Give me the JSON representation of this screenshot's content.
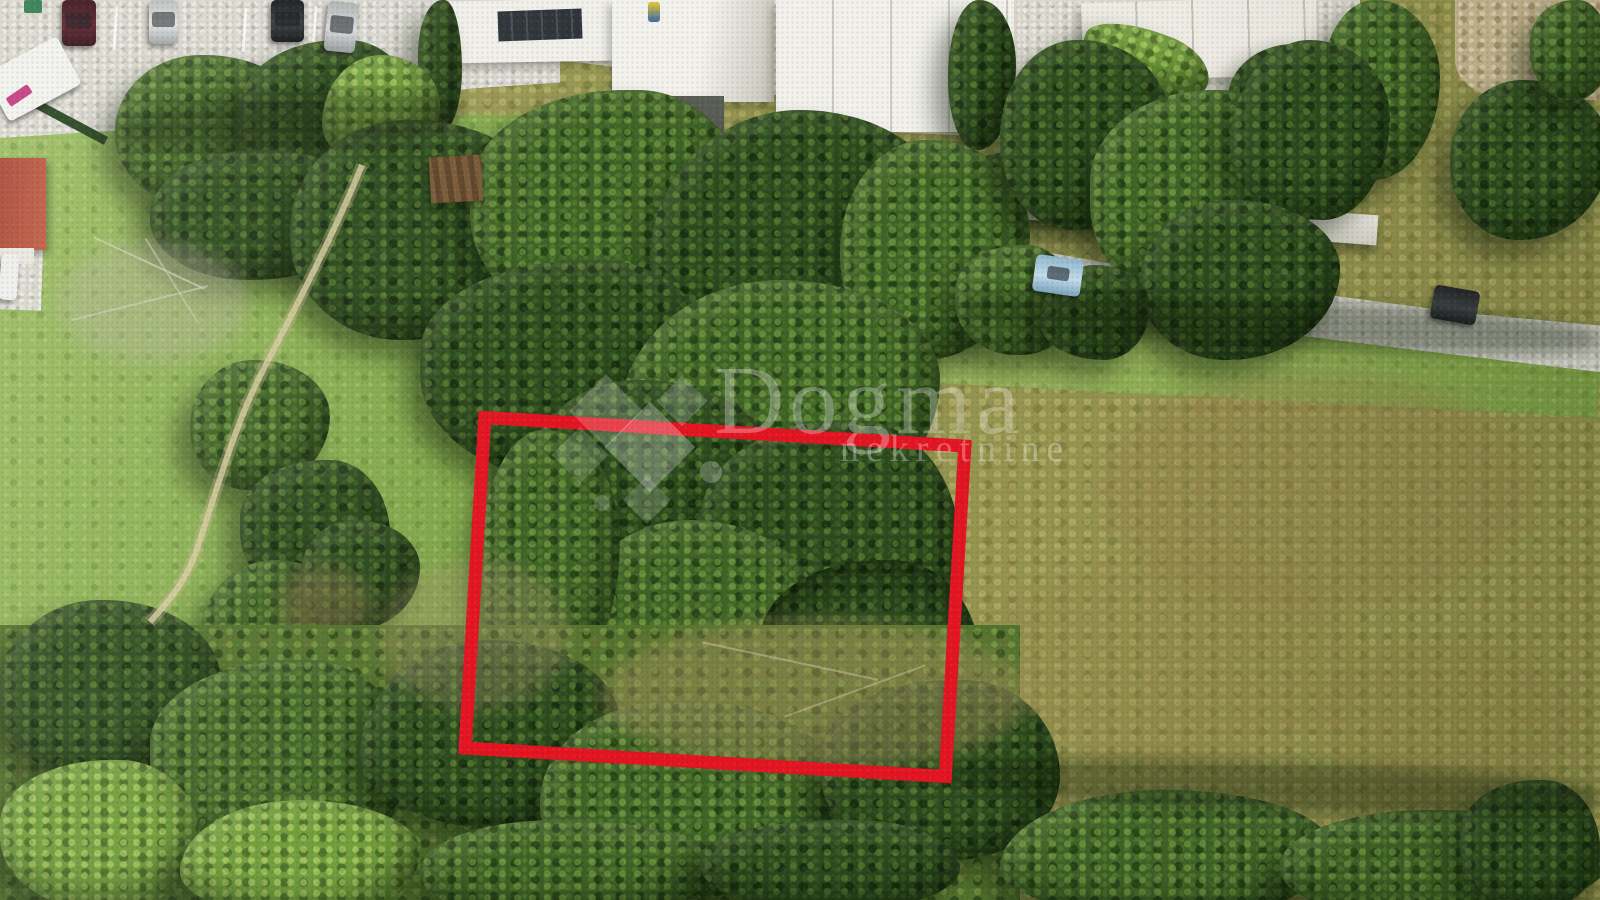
{
  "image": {
    "kind": "aerial-drone-photo",
    "subject": "Land plot for sale outlined in red, surrounded by trees, grass field and dry meadow, street with houses and parked cars at top",
    "width_px": 1600,
    "height_px": 900
  },
  "watermark": {
    "brand": "Dogma",
    "subtitle": "nekretnine",
    "logo": "diamond-cluster",
    "color": "#ffffff"
  },
  "plot_outline": {
    "shape": "rectangle",
    "color": "#e41522",
    "stroke_px": 13,
    "rotation_deg": 3.4
  },
  "scene": {
    "top": "paved street and driveways with white flat-roof houses",
    "left": "bright green grass field with worn footpath and bushes",
    "center": "dense tree canopy covering the outlined plot",
    "right": "dry olive-green scrub meadow",
    "bottom": "dense shrubs and scrub vegetation",
    "vehicles": [
      {
        "name": "parked-car-1",
        "color": "dark-red"
      },
      {
        "name": "parked-car-2",
        "color": "silver"
      },
      {
        "name": "parked-car-3",
        "color": "black"
      },
      {
        "name": "parked-car-4",
        "color": "silver"
      },
      {
        "name": "white-van",
        "color": "white"
      },
      {
        "name": "road-car-blue",
        "color": "light-blue"
      },
      {
        "name": "road-car-dark",
        "color": "dark-grey"
      },
      {
        "name": "parked-car-white",
        "color": "white"
      }
    ],
    "landmarks": [
      "red-roof-house",
      "wooden-shed",
      "white-terrace",
      "garden-wall",
      "hedges",
      "solar-panels"
    ]
  },
  "css_vars": {
    "plot-outline": "#e41522",
    "wm-color": "rgba(255,255,255,0.30)"
  }
}
